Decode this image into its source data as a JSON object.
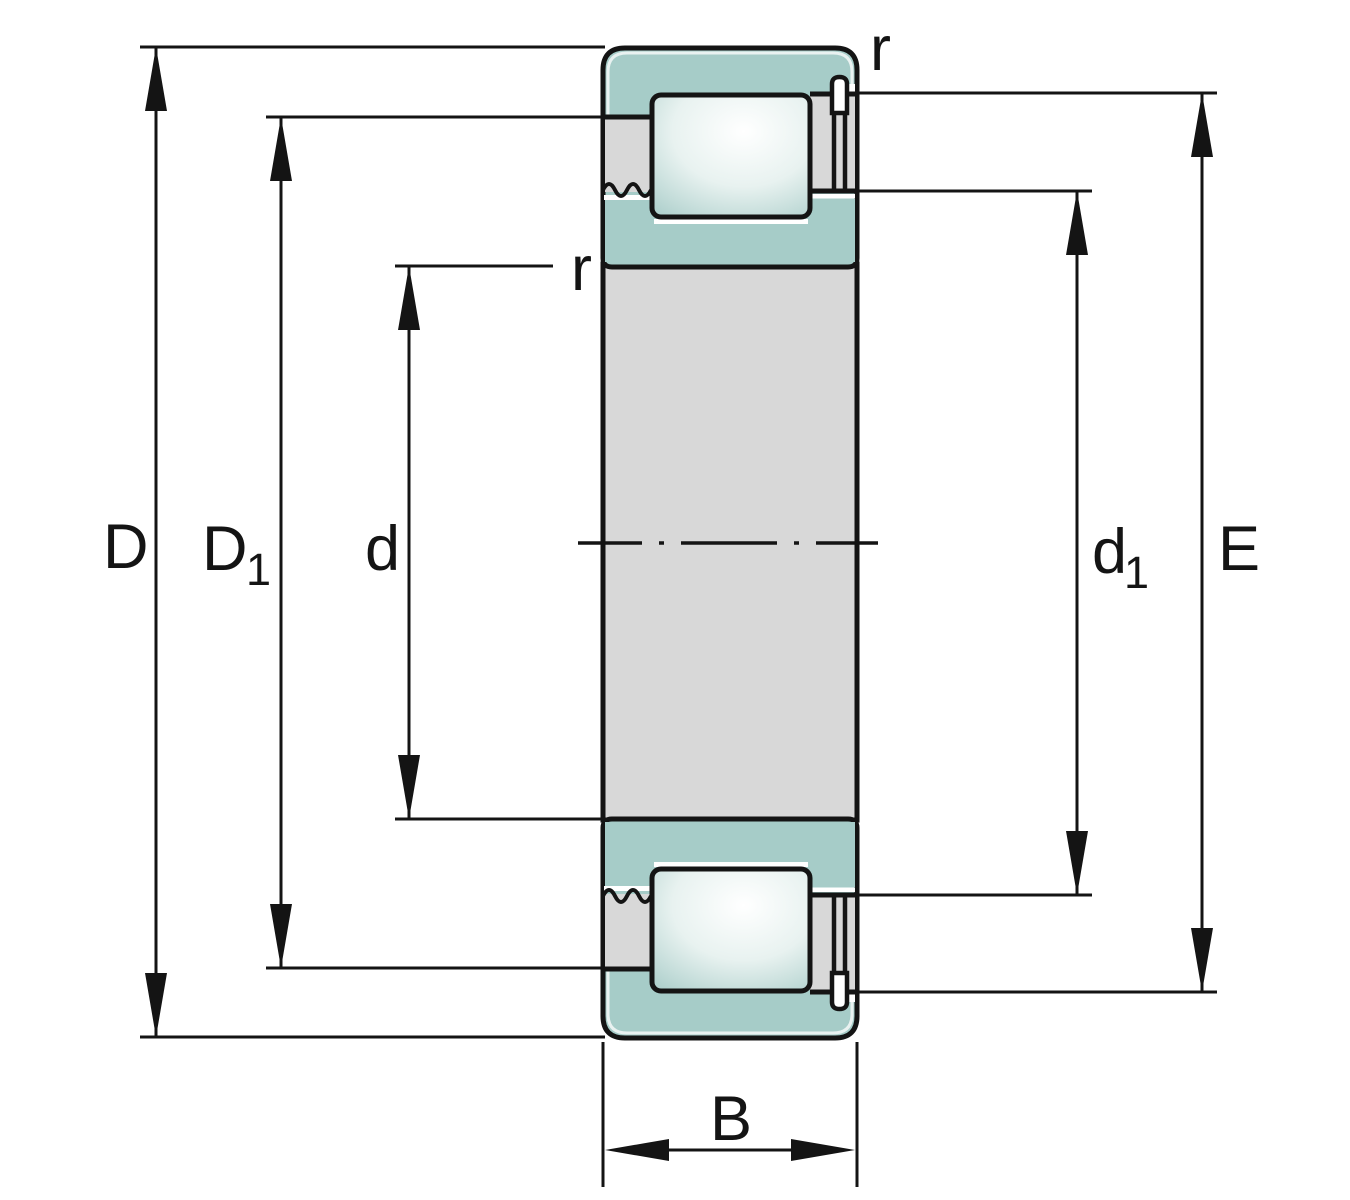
{
  "labels": {
    "outside_diameter": "D",
    "shoulder_diameter_base": "D",
    "shoulder_diameter_sub": "1",
    "bore_diameter": "d",
    "inner_shoulder_base": "d",
    "inner_shoulder_sub": "1",
    "raceway_diameter": "E",
    "width": "B",
    "chamfer_outer": "r",
    "chamfer_inner": "r"
  },
  "colors": {
    "line": "#141414",
    "ring": "#a6ccc8",
    "cage": "#d8d8d8",
    "highlight": "#ffffff",
    "roller_mid": "#ffffff",
    "roller_edge": "#9cc5c1"
  }
}
